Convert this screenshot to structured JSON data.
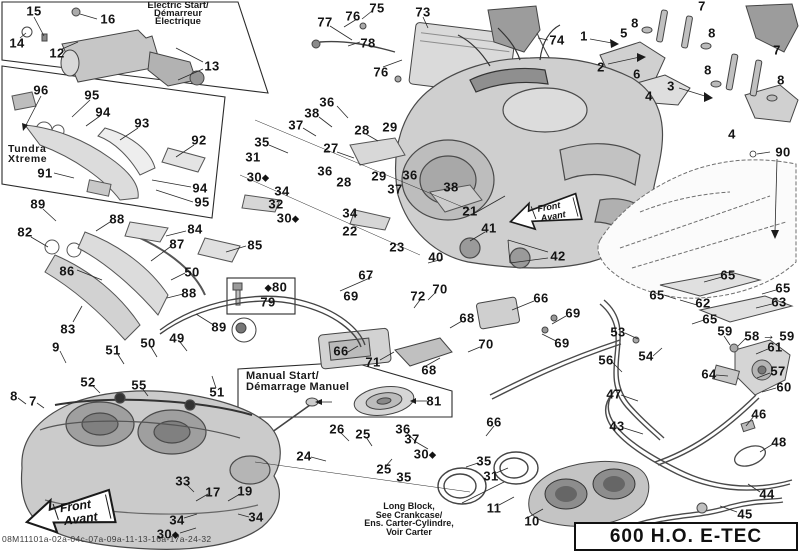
{
  "labels": {
    "electric": [
      "Electric Start/",
      "Démarreur",
      "Électrique"
    ],
    "tundra": [
      "Tundra",
      "Xtreme"
    ],
    "manual": [
      "Manual Start/",
      "Démarrage Manuel"
    ],
    "long_block": [
      "Long Block,",
      "See Crankcase/",
      "Ens. Carter-Cylindre,",
      "Voir Carter"
    ],
    "model": "600 H.O. E-TEC",
    "front_arrow": [
      "Front",
      "Avant"
    ],
    "footer_code": "08M11101a-02a-04c-07a-09a-11-13-16a-17a-24-32"
  },
  "colors": {
    "line": "#2b2b2b",
    "engine_fill": "#cfcfcf",
    "dark_part": "#9c9c9c",
    "text": "#141414"
  },
  "callouts": [
    {
      "n": "15",
      "x": 34,
      "y": 11
    },
    {
      "n": "16",
      "x": 108,
      "y": 19
    },
    {
      "n": "14",
      "x": 17,
      "y": 43
    },
    {
      "n": "12",
      "x": 57,
      "y": 53
    },
    {
      "n": "13",
      "x": 212,
      "y": 66
    },
    {
      "n": "77",
      "x": 325,
      "y": 22
    },
    {
      "n": "76",
      "x": 353,
      "y": 16
    },
    {
      "n": "75",
      "x": 377,
      "y": 8
    },
    {
      "n": "73",
      "x": 423,
      "y": 12
    },
    {
      "n": "78",
      "x": 368,
      "y": 43
    },
    {
      "n": "76",
      "x": 381,
      "y": 72
    },
    {
      "n": "74",
      "x": 557,
      "y": 40
    },
    {
      "n": "1",
      "x": 584,
      "y": 36
    },
    {
      "n": "5",
      "x": 624,
      "y": 33
    },
    {
      "n": "7",
      "x": 702,
      "y": 6
    },
    {
      "n": "8",
      "x": 635,
      "y": 23
    },
    {
      "n": "8",
      "x": 712,
      "y": 33
    },
    {
      "n": "2",
      "x": 601,
      "y": 67
    },
    {
      "n": "6",
      "x": 637,
      "y": 74
    },
    {
      "n": "3",
      "x": 671,
      "y": 86
    },
    {
      "n": "7",
      "x": 777,
      "y": 50
    },
    {
      "n": "8",
      "x": 708,
      "y": 70
    },
    {
      "n": "8",
      "x": 781,
      "y": 80
    },
    {
      "n": "4",
      "x": 649,
      "y": 96
    },
    {
      "n": "4",
      "x": 732,
      "y": 134
    },
    {
      "n": "96",
      "x": 41,
      "y": 90
    },
    {
      "n": "95",
      "x": 92,
      "y": 95
    },
    {
      "n": "94",
      "x": 103,
      "y": 112
    },
    {
      "n": "93",
      "x": 142,
      "y": 123
    },
    {
      "n": "92",
      "x": 199,
      "y": 140
    },
    {
      "n": "91",
      "x": 45,
      "y": 173
    },
    {
      "n": "94",
      "x": 200,
      "y": 188
    },
    {
      "n": "95",
      "x": 202,
      "y": 202
    },
    {
      "n": "89",
      "x": 38,
      "y": 204
    },
    {
      "n": "88",
      "x": 117,
      "y": 219
    },
    {
      "n": "82",
      "x": 25,
      "y": 232
    },
    {
      "n": "84",
      "x": 195,
      "y": 229
    },
    {
      "n": "87",
      "x": 177,
      "y": 244
    },
    {
      "n": "85",
      "x": 255,
      "y": 245
    },
    {
      "n": "86",
      "x": 67,
      "y": 271
    },
    {
      "n": "50",
      "x": 192,
      "y": 272
    },
    {
      "n": "88",
      "x": 189,
      "y": 293
    },
    {
      "n": "83",
      "x": 68,
      "y": 329
    },
    {
      "n": "89",
      "x": 219,
      "y": 327
    },
    {
      "n": "36",
      "x": 327,
      "y": 102
    },
    {
      "n": "38",
      "x": 312,
      "y": 113
    },
    {
      "n": "37",
      "x": 296,
      "y": 125
    },
    {
      "n": "28",
      "x": 362,
      "y": 130
    },
    {
      "n": "29",
      "x": 390,
      "y": 127
    },
    {
      "n": "35",
      "x": 262,
      "y": 142
    },
    {
      "n": "27",
      "x": 331,
      "y": 148
    },
    {
      "n": "31",
      "x": 253,
      "y": 157
    },
    {
      "n": "36",
      "x": 325,
      "y": 171
    },
    {
      "n": "30",
      "x": 258,
      "y": 177,
      "d": "post"
    },
    {
      "n": "28",
      "x": 344,
      "y": 182
    },
    {
      "n": "29",
      "x": 379,
      "y": 176
    },
    {
      "n": "36",
      "x": 410,
      "y": 175
    },
    {
      "n": "37",
      "x": 395,
      "y": 189
    },
    {
      "n": "34",
      "x": 282,
      "y": 191
    },
    {
      "n": "32",
      "x": 276,
      "y": 204
    },
    {
      "n": "30",
      "x": 288,
      "y": 218,
      "d": "post"
    },
    {
      "n": "34",
      "x": 350,
      "y": 213
    },
    {
      "n": "22",
      "x": 350,
      "y": 231
    },
    {
      "n": "23",
      "x": 397,
      "y": 247
    },
    {
      "n": "38",
      "x": 451,
      "y": 187
    },
    {
      "n": "21",
      "x": 470,
      "y": 211
    },
    {
      "n": "40",
      "x": 436,
      "y": 257
    },
    {
      "n": "41",
      "x": 489,
      "y": 228
    },
    {
      "n": "42",
      "x": 558,
      "y": 256
    },
    {
      "n": "67",
      "x": 366,
      "y": 275
    },
    {
      "n": "80",
      "x": 276,
      "y": 287,
      "d": "pre"
    },
    {
      "n": "79",
      "x": 268,
      "y": 302
    },
    {
      "n": "69",
      "x": 351,
      "y": 296
    },
    {
      "n": "70",
      "x": 440,
      "y": 289
    },
    {
      "n": "72",
      "x": 418,
      "y": 296
    },
    {
      "n": "66",
      "x": 541,
      "y": 298
    },
    {
      "n": "68",
      "x": 467,
      "y": 318
    },
    {
      "n": "69",
      "x": 573,
      "y": 313
    },
    {
      "n": "69",
      "x": 562,
      "y": 343
    },
    {
      "n": "66",
      "x": 341,
      "y": 351
    },
    {
      "n": "71",
      "x": 373,
      "y": 362
    },
    {
      "n": "68",
      "x": 429,
      "y": 370
    },
    {
      "n": "70",
      "x": 486,
      "y": 344
    },
    {
      "n": "90",
      "x": 783,
      "y": 152
    },
    {
      "n": "65",
      "x": 728,
      "y": 275
    },
    {
      "n": "65",
      "x": 657,
      "y": 295
    },
    {
      "n": "62",
      "x": 703,
      "y": 303
    },
    {
      "n": "65",
      "x": 783,
      "y": 288
    },
    {
      "n": "63",
      "x": 779,
      "y": 302
    },
    {
      "n": "65",
      "x": 710,
      "y": 319
    },
    {
      "n": "53",
      "x": 618,
      "y": 332
    },
    {
      "n": "59",
      "x": 725,
      "y": 331
    },
    {
      "n": "58",
      "x": 752,
      "y": 336
    },
    {
      "n": "→",
      "x": 769,
      "y": 335
    },
    {
      "n": "59",
      "x": 787,
      "y": 336
    },
    {
      "n": "61",
      "x": 775,
      "y": 347
    },
    {
      "n": "54",
      "x": 646,
      "y": 356
    },
    {
      "n": "56",
      "x": 606,
      "y": 360
    },
    {
      "n": "64",
      "x": 709,
      "y": 374
    },
    {
      "n": "57",
      "x": 778,
      "y": 371
    },
    {
      "n": "60",
      "x": 784,
      "y": 387
    },
    {
      "n": "47",
      "x": 614,
      "y": 394
    },
    {
      "n": "46",
      "x": 759,
      "y": 414
    },
    {
      "n": "48",
      "x": 779,
      "y": 442
    },
    {
      "n": "43",
      "x": 617,
      "y": 426
    },
    {
      "n": "44",
      "x": 767,
      "y": 494
    },
    {
      "n": "45",
      "x": 745,
      "y": 514
    },
    {
      "n": "66",
      "x": 494,
      "y": 422
    },
    {
      "n": "26",
      "x": 337,
      "y": 429
    },
    {
      "n": "25",
      "x": 363,
      "y": 434
    },
    {
      "n": "36",
      "x": 403,
      "y": 429
    },
    {
      "n": "37",
      "x": 412,
      "y": 439
    },
    {
      "n": "24",
      "x": 304,
      "y": 456
    },
    {
      "n": "30",
      "x": 425,
      "y": 454,
      "d": "post"
    },
    {
      "n": "25",
      "x": 384,
      "y": 469
    },
    {
      "n": "35",
      "x": 404,
      "y": 477
    },
    {
      "n": "35",
      "x": 484,
      "y": 461
    },
    {
      "n": "31",
      "x": 491,
      "y": 476
    },
    {
      "n": "81",
      "x": 434,
      "y": 401
    },
    {
      "n": "11",
      "x": 494,
      "y": 508
    },
    {
      "n": "10",
      "x": 532,
      "y": 521
    },
    {
      "n": "9",
      "x": 56,
      "y": 347
    },
    {
      "n": "51",
      "x": 113,
      "y": 350
    },
    {
      "n": "50",
      "x": 148,
      "y": 343
    },
    {
      "n": "49",
      "x": 177,
      "y": 338
    },
    {
      "n": "51",
      "x": 217,
      "y": 392
    },
    {
      "n": "52",
      "x": 88,
      "y": 382
    },
    {
      "n": "55",
      "x": 139,
      "y": 385
    },
    {
      "n": "8",
      "x": 14,
      "y": 396
    },
    {
      "n": "7",
      "x": 33,
      "y": 401
    },
    {
      "n": "33",
      "x": 183,
      "y": 481
    },
    {
      "n": "17",
      "x": 213,
      "y": 492
    },
    {
      "n": "19",
      "x": 245,
      "y": 491
    },
    {
      "n": "34",
      "x": 177,
      "y": 520
    },
    {
      "n": "34",
      "x": 256,
      "y": 517
    },
    {
      "n": "30",
      "x": 168,
      "y": 534,
      "d": "post"
    }
  ]
}
